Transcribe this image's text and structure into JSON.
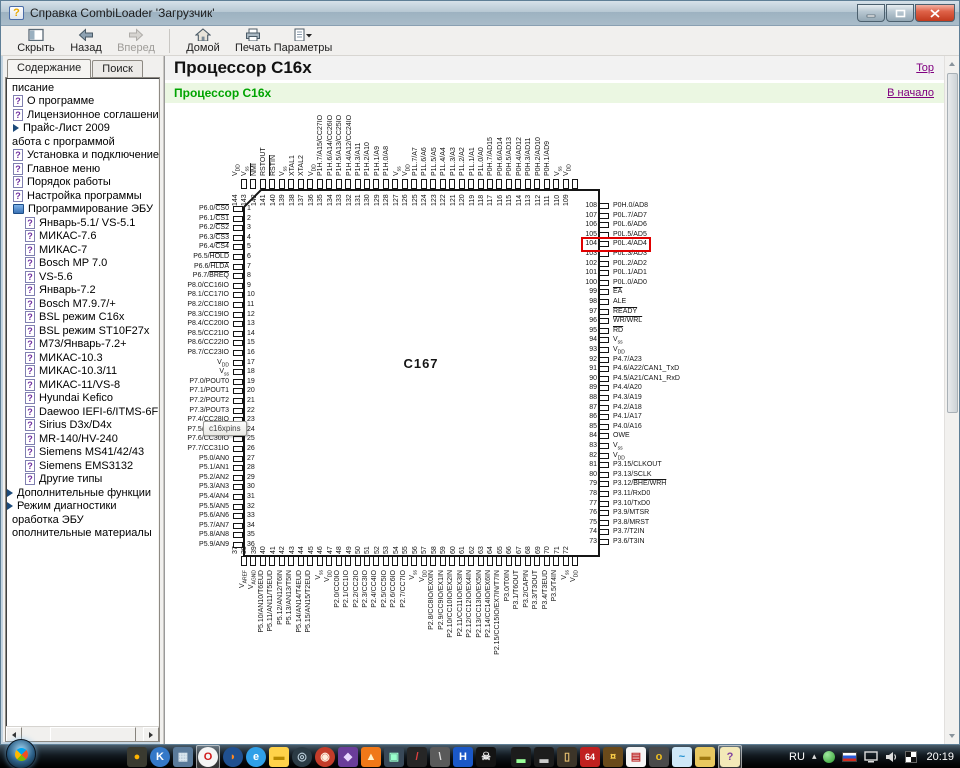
{
  "window": {
    "title": "Справка CombiLoader 'Загрузчик'"
  },
  "window_controls": [
    "minimize",
    "maximize",
    "close"
  ],
  "toolbar": {
    "buttons": [
      {
        "id": "hide",
        "label": "Скрыть"
      },
      {
        "id": "back",
        "label": "Назад"
      },
      {
        "id": "forward",
        "label": "Вперед",
        "disabled": true
      },
      {
        "id": "home",
        "label": "Домой",
        "sep_before": true
      },
      {
        "id": "print",
        "label": "Печать"
      },
      {
        "id": "options",
        "label": "Параметры",
        "dropdown": true
      }
    ]
  },
  "sidebar": {
    "tabs": [
      {
        "label": "Содержание",
        "active": true
      },
      {
        "label": "Поиск",
        "active": false
      }
    ],
    "tree": [
      {
        "label": "писание",
        "indent": 2,
        "icon": "none"
      },
      {
        "label": "О программе",
        "indent": 7,
        "icon": "pageq"
      },
      {
        "label": "Лицензионное соглашение",
        "indent": 7,
        "icon": "pageq"
      },
      {
        "label": "Прайс-Лист 2009",
        "indent": 7,
        "icon": "arrow"
      },
      {
        "label": "абота с программой",
        "indent": 2,
        "icon": "none"
      },
      {
        "label": "Установка и подключение",
        "indent": 7,
        "icon": "pageq"
      },
      {
        "label": "Главное меню",
        "indent": 7,
        "icon": "pageq"
      },
      {
        "label": "Порядок работы",
        "indent": 7,
        "icon": "pageq"
      },
      {
        "label": "Настройка программы",
        "indent": 7,
        "icon": "pageq"
      },
      {
        "label": "Программирование ЭБУ",
        "indent": 7,
        "icon": "book"
      },
      {
        "label": "Январь-5.1/ VS-5.1",
        "indent": 19,
        "icon": "pageq"
      },
      {
        "label": "МИКАС-7.6",
        "indent": 19,
        "icon": "pageq"
      },
      {
        "label": "МИКАС-7",
        "indent": 19,
        "icon": "pageq"
      },
      {
        "label": "Bosch MP 7.0",
        "indent": 19,
        "icon": "pageq"
      },
      {
        "label": "VS-5.6",
        "indent": 19,
        "icon": "pageq"
      },
      {
        "label": "Январь-7.2",
        "indent": 19,
        "icon": "pageq"
      },
      {
        "label": "Bosch M7.9.7/+",
        "indent": 19,
        "icon": "pageq"
      },
      {
        "label": "BSL режим C16x",
        "indent": 19,
        "icon": "pageq"
      },
      {
        "label": "BSL режим ST10F27x",
        "indent": 19,
        "icon": "pageq"
      },
      {
        "label": "М73/Январь-7.2+",
        "indent": 19,
        "icon": "pageq"
      },
      {
        "label": "МИКАС-10.3",
        "indent": 19,
        "icon": "pageq"
      },
      {
        "label": "МИКАС-10.3/11",
        "indent": 19,
        "icon": "pageq"
      },
      {
        "label": "МИКАС-11/VS-8",
        "indent": 19,
        "icon": "pageq"
      },
      {
        "label": "Hyundai Kefico",
        "indent": 19,
        "icon": "pageq"
      },
      {
        "label": "Daewoo IEFI-6/ITMS-6F",
        "indent": 19,
        "icon": "pageq"
      },
      {
        "label": "Sirius D3x/D4x",
        "indent": 19,
        "icon": "pageq"
      },
      {
        "label": "MR-140/HV-240",
        "indent": 19,
        "icon": "pageq"
      },
      {
        "label": "Siemens MS41/42/43",
        "indent": 19,
        "icon": "pageq"
      },
      {
        "label": "Siemens EMS3132",
        "indent": 19,
        "icon": "pageq"
      },
      {
        "label": "Другие типы",
        "indent": 19,
        "icon": "pageq"
      },
      {
        "label": "Дополнительные функции",
        "indent": 1,
        "icon": "arrow"
      },
      {
        "label": "Режим диагностики",
        "indent": 1,
        "icon": "arrow"
      },
      {
        "label": "оработка ЭБУ",
        "indent": 2,
        "icon": "none"
      },
      {
        "label": "ополнительные материалы",
        "indent": 2,
        "icon": "none"
      }
    ]
  },
  "content": {
    "page_title": "Процессор C16x",
    "top_link": "Top",
    "heading": "Процессор C16x",
    "home_link": "В начало"
  },
  "chip": {
    "name": "C167",
    "tooltip": "c16xpins",
    "highlight_pin": "104",
    "left": [
      [
        "1",
        "P6.0/[CS0]"
      ],
      [
        "2",
        "P6.1/[CS1]"
      ],
      [
        "3",
        "P6.2/[CS2]"
      ],
      [
        "4",
        "P6.3/[CS3]"
      ],
      [
        "5",
        "P6.4/[CS4]"
      ],
      [
        "6",
        "P6.5/[HOLD]"
      ],
      [
        "7",
        "P6.6/[HLDA]"
      ],
      [
        "8",
        "P6.7/[BREQ]"
      ],
      [
        "9",
        "P8.0/CC16IO"
      ],
      [
        "10",
        "P8.1/CC17IO"
      ],
      [
        "11",
        "P8.2/CC18IO"
      ],
      [
        "12",
        "P8.3/CC19IO"
      ],
      [
        "13",
        "P8.4/CC20IO"
      ],
      [
        "14",
        "P8.5/CC21IO"
      ],
      [
        "15",
        "P8.6/CC22IO"
      ],
      [
        "16",
        "P8.7/CC23IO"
      ],
      [
        "17",
        "V{DD}"
      ],
      [
        "18",
        "V{ss}"
      ],
      [
        "19",
        "P7.0/POUT0"
      ],
      [
        "20",
        "P7.1/POUT1"
      ],
      [
        "21",
        "P7.2/POUT2"
      ],
      [
        "22",
        "P7.3/POUT3"
      ],
      [
        "23",
        "P7.4/CC28IO"
      ],
      [
        "24",
        "P7.5/CC29IO"
      ],
      [
        "25",
        "P7.6/CC30IO"
      ],
      [
        "26",
        "P7.7/CC31IO"
      ],
      [
        "27",
        "P5.0/AN0"
      ],
      [
        "28",
        "P5.1/AN1"
      ],
      [
        "29",
        "P5.2/AN2"
      ],
      [
        "30",
        "P5.3/AN3"
      ],
      [
        "31",
        "P5.4/AN4"
      ],
      [
        "32",
        "P5.5/AN5"
      ],
      [
        "33",
        "P5.6/AN6"
      ],
      [
        "34",
        "P5.7/AN7"
      ],
      [
        "35",
        "P5.8/AN8"
      ],
      [
        "36",
        "P5.9/AN9"
      ]
    ],
    "top": [
      [
        "144",
        "V{DD}"
      ],
      [
        "143",
        "V{ss}"
      ],
      [
        "142",
        "[NMI]"
      ],
      [
        "141",
        "RSTOUT"
      ],
      [
        "140",
        "[RSTIN]"
      ],
      [
        "139",
        "V{ss}"
      ],
      [
        "138",
        "XTAL1"
      ],
      [
        "137",
        "XTAL2"
      ],
      [
        "136",
        "V{DD}"
      ],
      [
        "135",
        "P1H.7/A15/CC27IO"
      ],
      [
        "134",
        "P1H.6/A14/CC26IO"
      ],
      [
        "133",
        "P1H.5/A13/CC25IO"
      ],
      [
        "132",
        "P1H.4/A12/CC24IO"
      ],
      [
        "131",
        "P1H.3/A11"
      ],
      [
        "130",
        "P1H.2/A10"
      ],
      [
        "129",
        "P1H.1/A9"
      ],
      [
        "128",
        "P1H.0/A8"
      ],
      [
        "127",
        "V{ss}"
      ],
      [
        "126",
        "V{DD}"
      ],
      [
        "125",
        "P1L.7/A7"
      ],
      [
        "124",
        "P1L.6/A6"
      ],
      [
        "123",
        "P1L.5/A5"
      ],
      [
        "122",
        "P1L.4/A4"
      ],
      [
        "121",
        "P1L.3/A3"
      ],
      [
        "120",
        "P1L.2/A2"
      ],
      [
        "119",
        "P1L.1/A1"
      ],
      [
        "118",
        "P1L.0/A0"
      ],
      [
        "117",
        "P0H.7/AD15"
      ],
      [
        "116",
        "P0H.6/AD14"
      ],
      [
        "115",
        "P0H.5/AD13"
      ],
      [
        "114",
        "P0H.4/AD12"
      ],
      [
        "113",
        "P0H.3/AD11"
      ],
      [
        "112",
        "P0H.2/AD10"
      ],
      [
        "111",
        "P0H.1/AD9"
      ],
      [
        "110",
        "V{ss}"
      ],
      [
        "109",
        "V{DD}"
      ]
    ],
    "right": [
      [
        "108",
        "P0H.0/AD8"
      ],
      [
        "107",
        "P0L.7/AD7"
      ],
      [
        "106",
        "P0L.6/AD6"
      ],
      [
        "105",
        "P0L.5/AD5"
      ],
      [
        "104",
        "P0L.4/AD4"
      ],
      [
        "103",
        "P0L.3/AD3"
      ],
      [
        "102",
        "P0L.2/AD2"
      ],
      [
        "101",
        "P0L.1/AD1"
      ],
      [
        "100",
        "P0L.0/AD0"
      ],
      [
        "99",
        "[EA]"
      ],
      [
        "98",
        "ALE"
      ],
      [
        "97",
        "[READY]"
      ],
      [
        "96",
        "[WR/WRL]"
      ],
      [
        "95",
        "[RD]"
      ],
      [
        "94",
        "V{ss}"
      ],
      [
        "93",
        "V{DD}"
      ],
      [
        "92",
        "P4.7/A23"
      ],
      [
        "91",
        "P4.6/A22/CAN1_TxD"
      ],
      [
        "90",
        "P4.5/A21/CAN1_RxD"
      ],
      [
        "89",
        "P4.4/A20"
      ],
      [
        "88",
        "P4.3/A19"
      ],
      [
        "87",
        "P4.2/A18"
      ],
      [
        "86",
        "P4.1/A17"
      ],
      [
        "85",
        "P4.0/A16"
      ],
      [
        "84",
        "OWE"
      ],
      [
        "83",
        "V{ss}"
      ],
      [
        "82",
        "V{DD}"
      ],
      [
        "81",
        "P3.15/CLKOUT"
      ],
      [
        "80",
        "P3.13/SCLK"
      ],
      [
        "79",
        "P3.12/[BHE/WRH]"
      ],
      [
        "78",
        "P3.11/RxD0"
      ],
      [
        "77",
        "P3.10/TxD0"
      ],
      [
        "76",
        "P3.9/MTSR"
      ],
      [
        "75",
        "P3.8/MRST"
      ],
      [
        "74",
        "P3.7/T2IN"
      ],
      [
        "73",
        "P3.6/T3IN"
      ]
    ],
    "bottom": [
      [
        "37",
        "V{AREF}"
      ],
      [
        "38",
        "V{AGND}"
      ],
      [
        "39",
        "P5.10/AN10/T6EUD"
      ],
      [
        "40",
        "P5.11/AN11/T5EUD"
      ],
      [
        "41",
        "P5.12/AN12/T6IN"
      ],
      [
        "42",
        "P5.13/AN13/T5IN"
      ],
      [
        "43",
        "P5.14/AN14/T4EUD"
      ],
      [
        "44",
        "P5.15/AN15/T2EUD"
      ],
      [
        "45",
        "V{ss}"
      ],
      [
        "46",
        "V{DD}"
      ],
      [
        "47",
        "P2.0/CC0IO"
      ],
      [
        "48",
        "P2.1/CC1IO"
      ],
      [
        "49",
        "P2.2/CC2IO"
      ],
      [
        "50",
        "P2.3/CC3IO"
      ],
      [
        "51",
        "P2.4/CC4IO"
      ],
      [
        "52",
        "P2.5/CC5IO"
      ],
      [
        "53",
        "P2.6/CC6IO"
      ],
      [
        "54",
        "P2.7/CC7IO"
      ],
      [
        "55",
        "V{ss}"
      ],
      [
        "56",
        "V{DD}"
      ],
      [
        "57",
        "P2.8/CC8IO/EX0IN"
      ],
      [
        "58",
        "P2.9/CC9IO/EX1IN"
      ],
      [
        "59",
        "P2.10/CC10IO/EX2IN"
      ],
      [
        "60",
        "P2.11/CC11IO/EX3IN"
      ],
      [
        "61",
        "P2.12/CC12IO/EX4IN"
      ],
      [
        "62",
        "P2.13/CC13IO/EX5IN"
      ],
      [
        "63",
        "P2.14/CC14IO/EX6IN"
      ],
      [
        "64",
        "P2.15/CC15IO/EX7IN/T7IN"
      ],
      [
        "65",
        "P3.0/T0IN"
      ],
      [
        "66",
        "P3.1/T6OUT"
      ],
      [
        "67",
        "P3.2/CAPIN"
      ],
      [
        "68",
        "P3.3/T3OUT"
      ],
      [
        "69",
        "P3.4/T3EUD"
      ],
      [
        "70",
        "P3.5/T4IN"
      ],
      [
        "71",
        "V{ss}"
      ],
      [
        "72",
        "V{DD}"
      ]
    ]
  },
  "colors": {
    "highlight_red": "#e00000",
    "link_purple": "#800080",
    "heading_green": "#00a400"
  },
  "taskbar": {
    "language": "RU",
    "clock": "20:19",
    "icons": [
      {
        "name": "amber-dot-app-icon",
        "glyph": "●",
        "bg": "#3a3a30",
        "fg": "#ffb400"
      },
      {
        "name": "kmplayer-icon",
        "glyph": "K",
        "bg": "#3478c8",
        "fg": "#ffffff",
        "round": true
      },
      {
        "name": "photo-viewer-icon",
        "glyph": "▦",
        "bg": "#5a7a9a",
        "fg": "#dce8f0"
      },
      {
        "name": "opera-icon",
        "glyph": "O",
        "bg": "#f5f5f5",
        "fg": "#d01818",
        "round": true,
        "active": true
      },
      {
        "name": "firefox-icon",
        "glyph": "◗",
        "bg": "#205090",
        "fg": "#ff8820",
        "round": true
      },
      {
        "name": "internet-explorer-icon",
        "glyph": "e",
        "bg": "#30a0e8",
        "fg": "#ffffff",
        "round": true
      },
      {
        "name": "folder-icon",
        "glyph": "▬",
        "bg": "#ffd24a",
        "fg": "#b98a00"
      },
      {
        "name": "media-player-icon",
        "glyph": "◎",
        "bg": "#2b3b45",
        "fg": "#b8ccd8",
        "round": true
      },
      {
        "name": "round-red-app-icon",
        "glyph": "◉",
        "bg": "#c43c2a",
        "fg": "#ffeedd",
        "round": true
      },
      {
        "name": "purple-app-icon",
        "glyph": "◆",
        "bg": "#6a3d9a",
        "fg": "#e8d8ff"
      },
      {
        "name": "flame-app-icon",
        "glyph": "▲",
        "bg": "#f07818",
        "fg": "#fff3cc"
      },
      {
        "name": "video-app-icon",
        "glyph": "▣",
        "bg": "#384858",
        "fg": "#99ffcc"
      },
      {
        "name": "pen-app-icon",
        "glyph": "/",
        "bg": "#262626",
        "fg": "#e04040"
      },
      {
        "name": "stylus-app-icon",
        "glyph": "\\",
        "bg": "#5a5a5a",
        "fg": "#dddddd"
      },
      {
        "name": "h-app-icon",
        "glyph": "H",
        "bg": "#1a58c8",
        "fg": "#ffffff"
      },
      {
        "name": "skull-app-icon",
        "glyph": "☠",
        "bg": "#141414",
        "fg": "#eeeeee"
      },
      {
        "name": "console-icon",
        "glyph": "▂",
        "bg": "#1c1c1c",
        "fg": "#99ff99",
        "gap": true
      },
      {
        "name": "console-icon-2",
        "glyph": "▂",
        "bg": "#1c1c1c",
        "fg": "#cccccc"
      },
      {
        "name": "doorway-app-icon",
        "glyph": "▯",
        "bg": "#3c3428",
        "fg": "#e8c070"
      },
      {
        "name": "app-64-icon",
        "glyph": "64",
        "bg": "#c02020",
        "fg": "#ffffff"
      },
      {
        "name": "badge-app-icon",
        "glyph": "¤",
        "bg": "#6a4a1a",
        "fg": "#ffd24a"
      },
      {
        "name": "doc-app-icon",
        "glyph": "▤",
        "bg": "#f5f5f5",
        "fg": "#c03030"
      },
      {
        "name": "key-app-icon",
        "glyph": "o",
        "bg": "#4a4a4a",
        "fg": "#f0c020"
      },
      {
        "name": "swoosh-app-icon",
        "glyph": "~",
        "bg": "#cfe8f8",
        "fg": "#2090d0"
      },
      {
        "name": "folder-2-icon",
        "glyph": "▬",
        "bg": "#e8c860",
        "fg": "#a07a10"
      },
      {
        "name": "help-viewer-icon",
        "glyph": "?",
        "bg": "#f3e9b8",
        "fg": "#8040a0",
        "active": true
      }
    ],
    "tray": [
      {
        "name": "hidden-icons-arrow",
        "glyph": "▴"
      },
      {
        "name": "antivirus-icon"
      },
      {
        "name": "ru-flag-icon"
      },
      {
        "name": "display-icon"
      },
      {
        "name": "volume-icon"
      },
      {
        "name": "checkered-icon"
      }
    ]
  }
}
